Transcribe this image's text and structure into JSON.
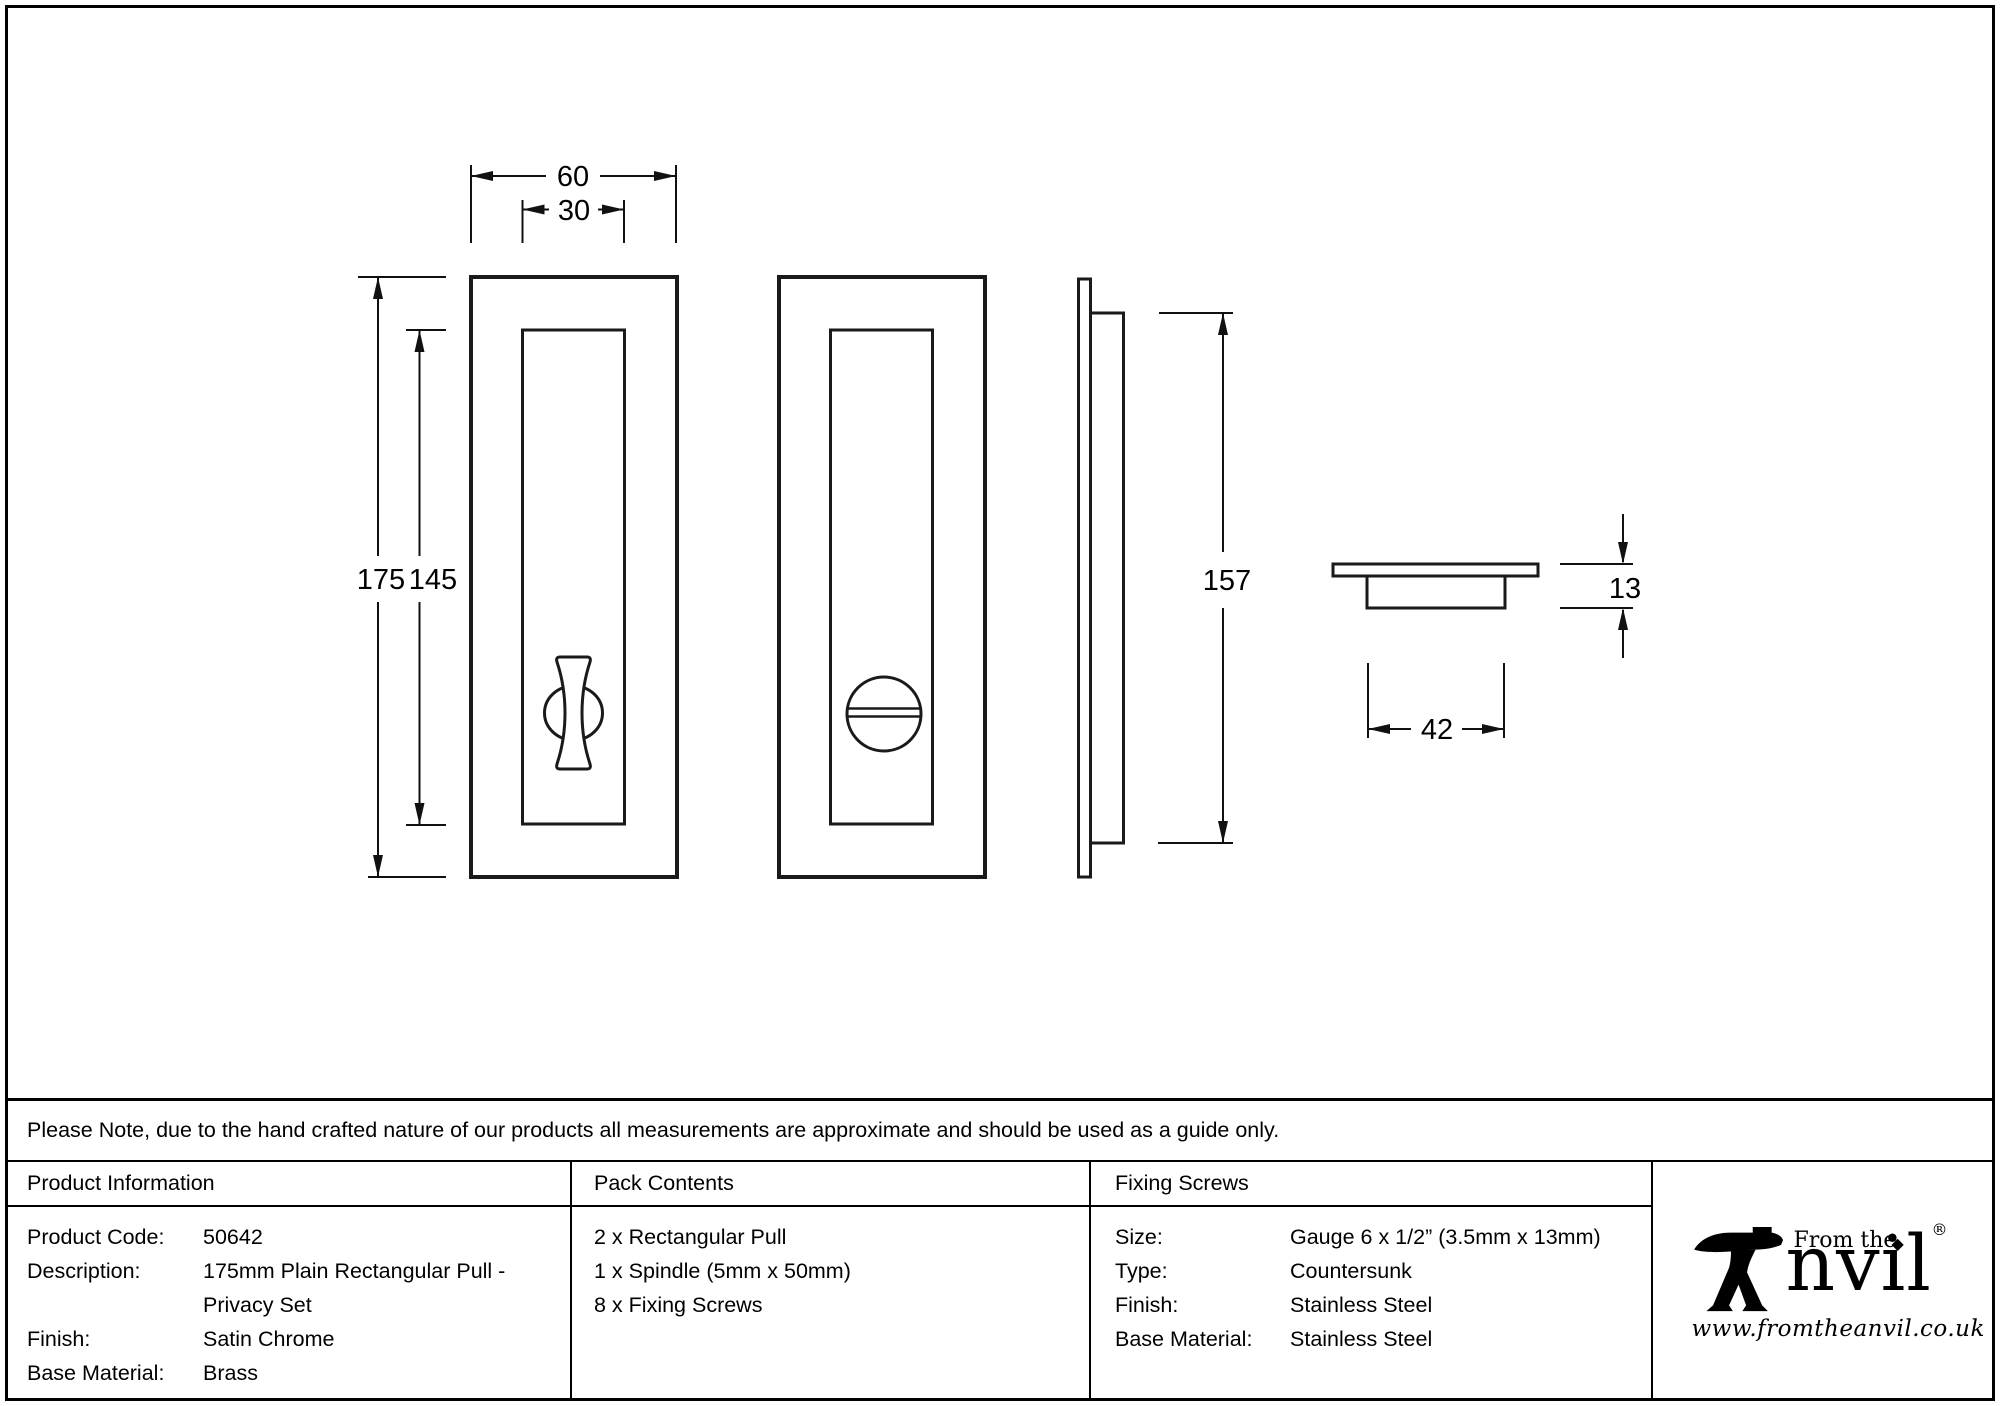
{
  "drawing": {
    "dimensions": {
      "front_width": "60",
      "front_inner_width": "30",
      "front_height": "175",
      "front_inner_height": "145",
      "side_height": "157",
      "section_depth": "13",
      "section_width": "42"
    }
  },
  "note": "Please Note, due to the hand crafted nature of our products all measurements are approximate and should be used as a guide only.",
  "table": {
    "product_info": {
      "header": "Product Information",
      "rows": [
        {
          "label": "Product Code:",
          "value": "50642"
        },
        {
          "label": "Description:",
          "value": "175mm Plain Rectangular Pull -"
        },
        {
          "label": "",
          "value": "Privacy Set"
        },
        {
          "label": "Finish:",
          "value": "Satin Chrome"
        },
        {
          "label": "Base Material:",
          "value": "Brass"
        }
      ]
    },
    "pack_contents": {
      "header": "Pack Contents",
      "items": [
        "2 x Rectangular Pull",
        "1 x Spindle (5mm x 50mm)",
        "8 x Fixing Screws"
      ]
    },
    "fixing_screws": {
      "header": "Fixing Screws",
      "rows": [
        {
          "label": "Size:",
          "value": "Gauge 6 x 1/2” (3.5mm x 13mm)"
        },
        {
          "label": "Type:",
          "value": "Countersunk"
        },
        {
          "label": "Finish:",
          "value": "Stainless Steel"
        },
        {
          "label": "Base Material:",
          "value": "Stainless Steel"
        }
      ]
    }
  },
  "logo": {
    "brand_top": "From the",
    "brand_main": "nvil",
    "diamond": "◆",
    "registered": "®",
    "website": "www.fromtheanvil.co.uk"
  }
}
